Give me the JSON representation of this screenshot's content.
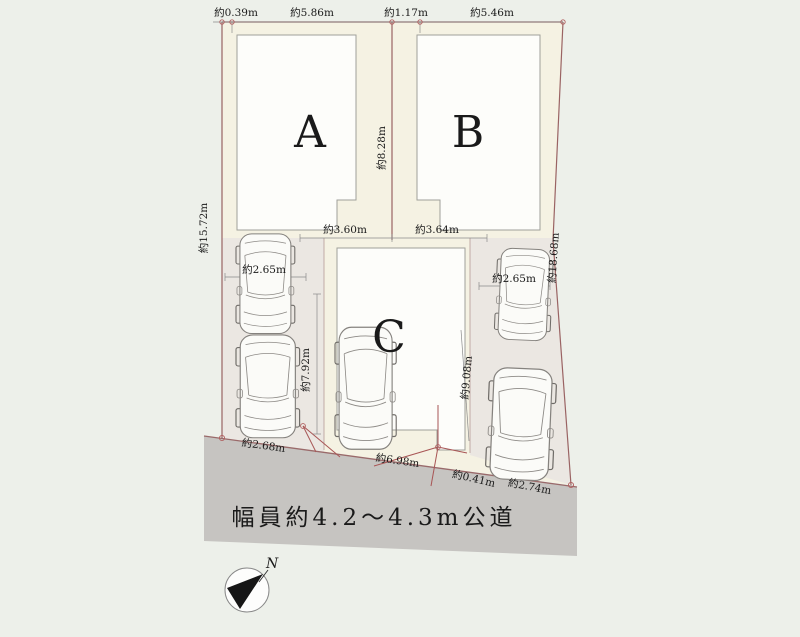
{
  "plan": {
    "type": "real-estate site plan",
    "lots": {
      "a": "A",
      "b": "B",
      "c": "C"
    },
    "dims": {
      "top_left": "約0.39m",
      "top_a": "約5.86m",
      "top_gap": "約1.17m",
      "top_b": "約5.46m",
      "left_side": "約15.72m",
      "center_divider": "約8.28m",
      "right_side": "約18.68m",
      "a_frontage": "約3.60m",
      "b_frontage": "約3.64m",
      "left_parking_width": "約2.65m",
      "right_parking_width": "約2.65m",
      "c_left_depth": "約7.92m",
      "c_right_depth": "約9.08m",
      "road_left": "約2.68m",
      "road_center": "約6.98m",
      "road_right_small": "約0.41m",
      "road_right": "約2.74m"
    },
    "road": {
      "label": "幅員約4.2～4.3m公道"
    },
    "compass": {
      "north": "N"
    },
    "colors": {
      "background": "#edf0ea",
      "parcel_cream": "#f5f2e3",
      "parking_gray": "#ebe7e2",
      "building_white": "#fdfdfa",
      "road_gray": "#c6c4c1",
      "boundary_line": "#9a6363",
      "witness_line": "#a85555"
    }
  }
}
